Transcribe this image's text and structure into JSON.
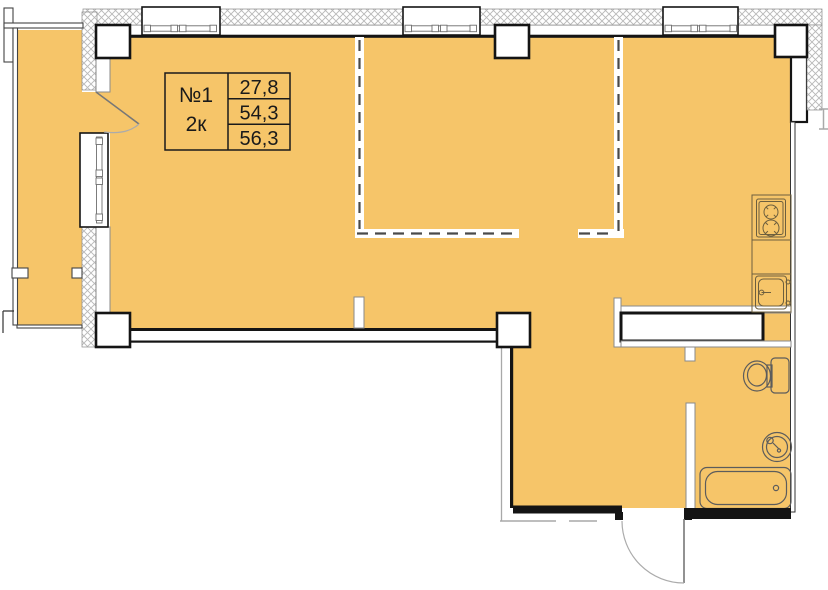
{
  "unit_card": {
    "number": "№1",
    "rooms": "2к",
    "area_row1": "27,8",
    "area_row2": "54,3",
    "area_row3": "56,3"
  },
  "colors": {
    "room": "#F6C569",
    "wall": "#141414",
    "hatch_line": "#B8B8B8",
    "thin_line": "#8A8A8A",
    "fixture": "#6D5F3E",
    "arc": "#ABABAB"
  }
}
